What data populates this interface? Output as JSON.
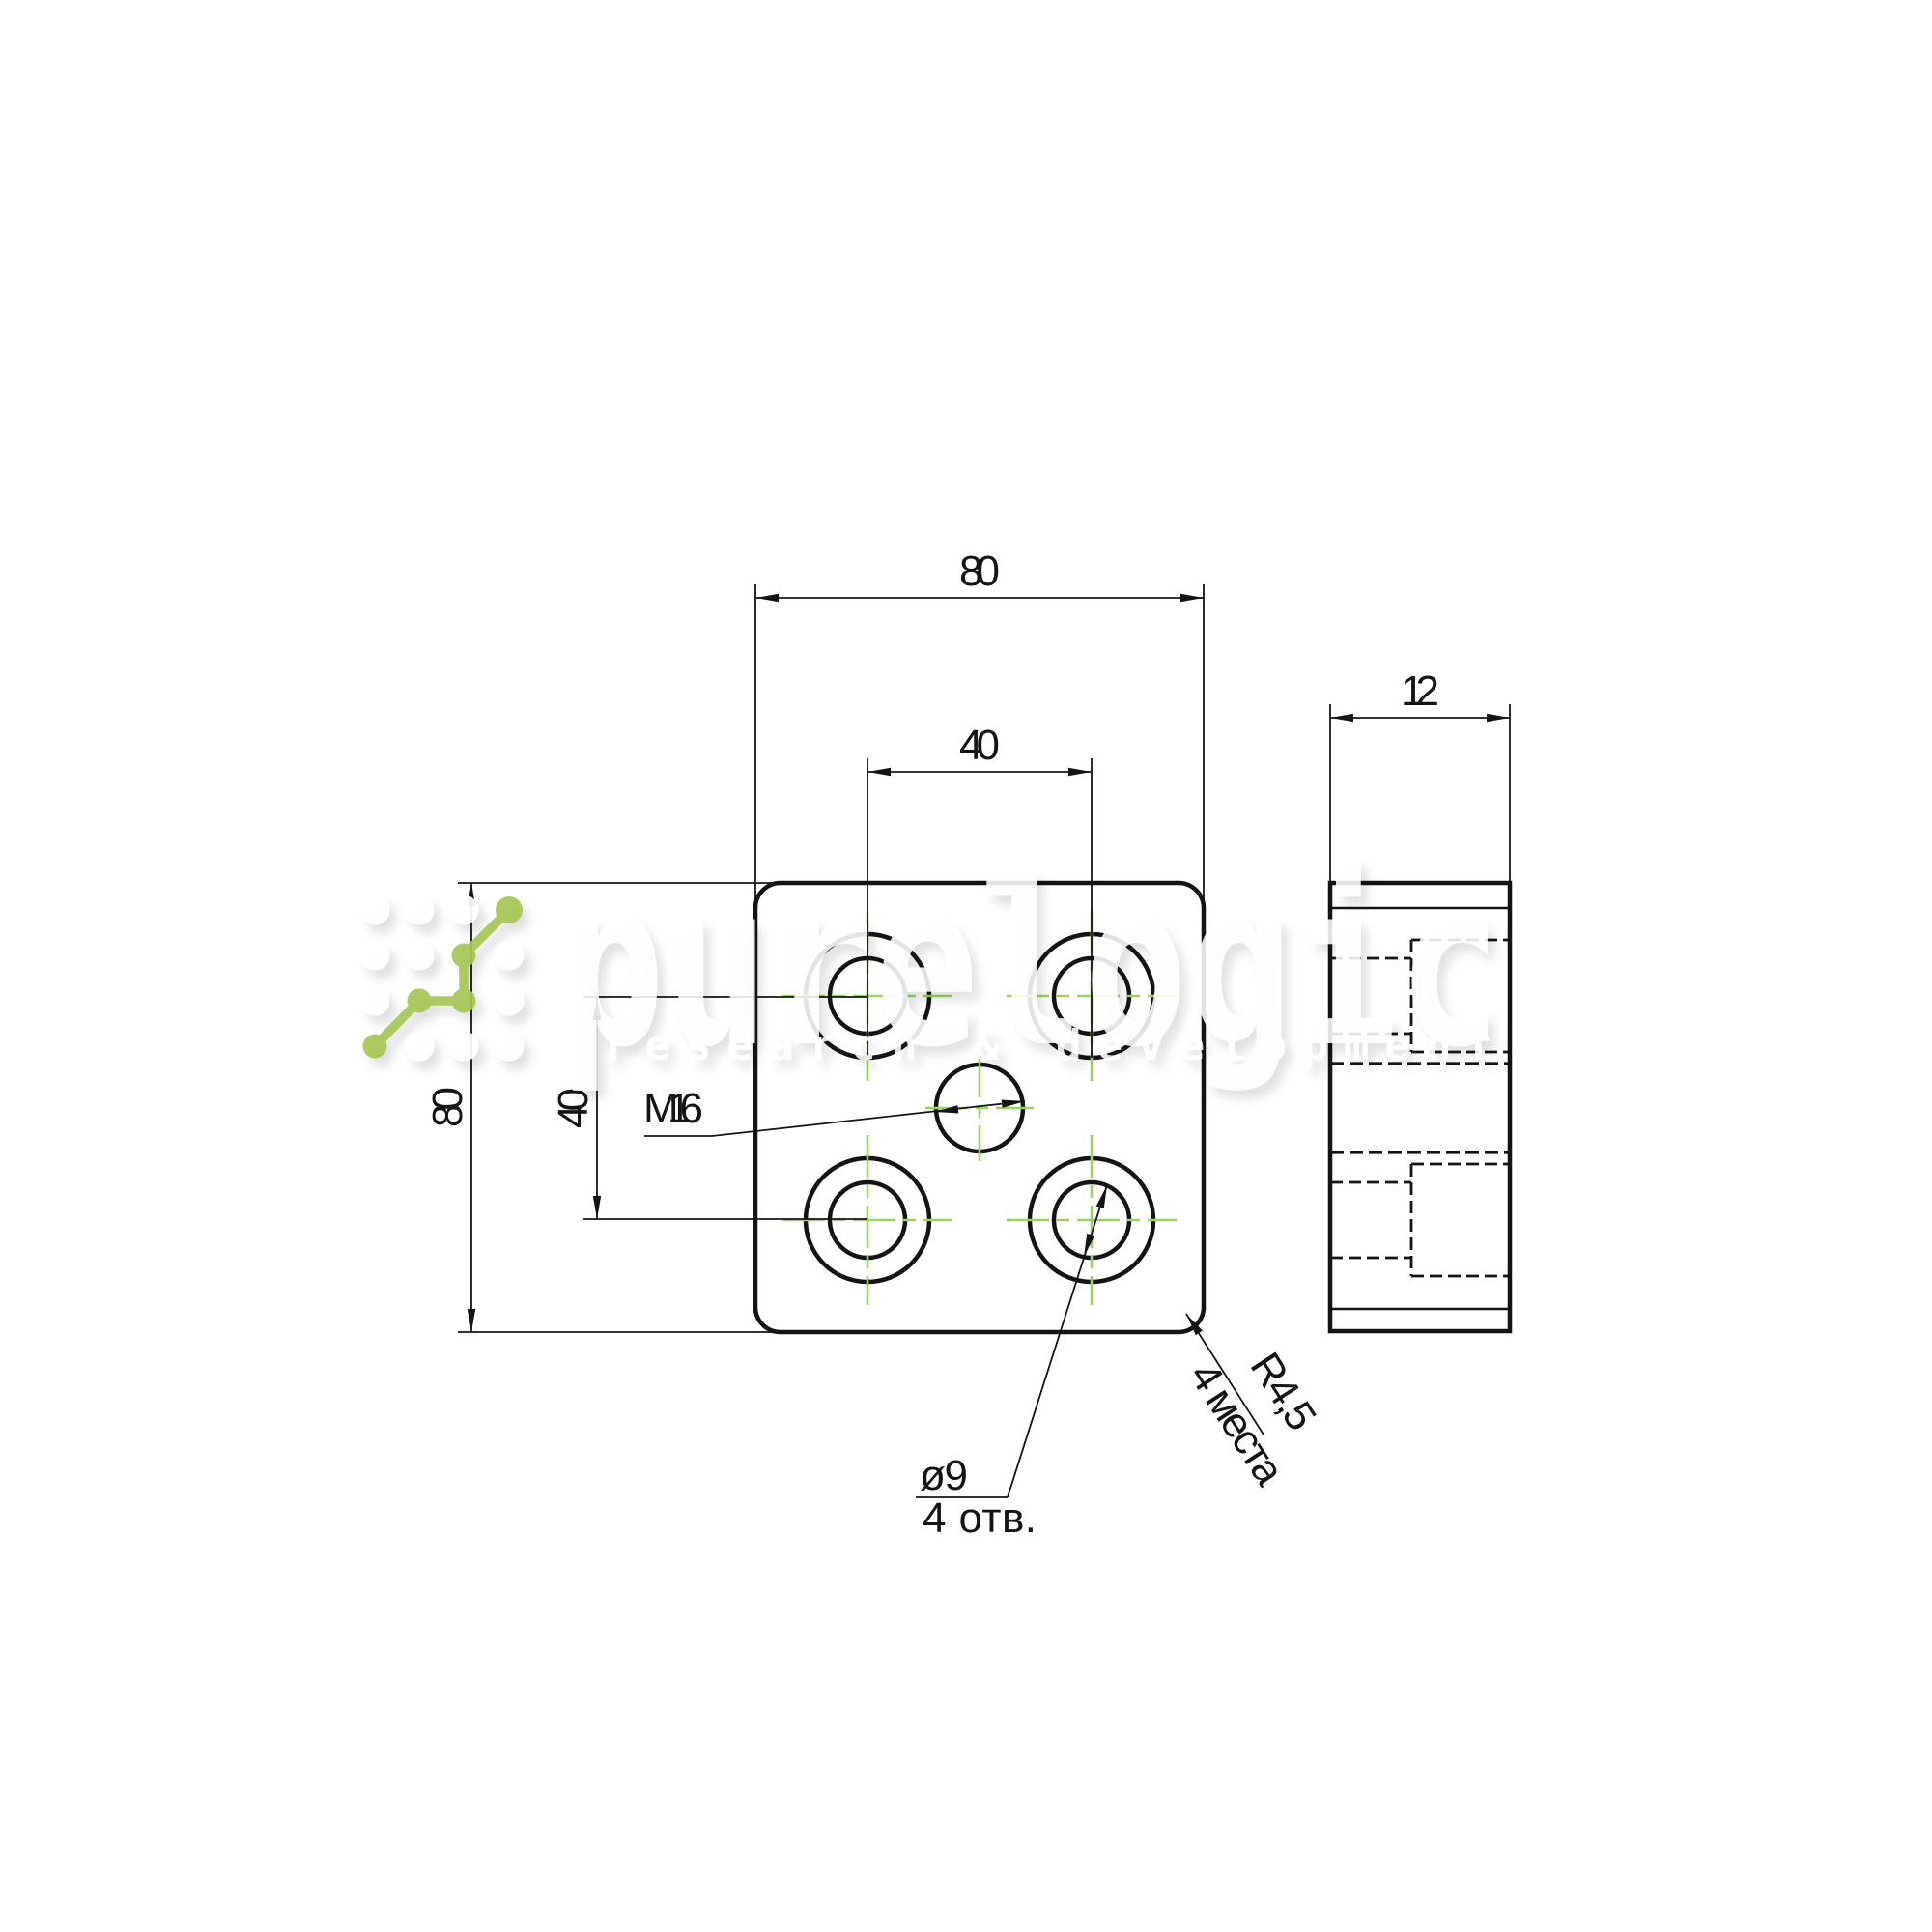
{
  "drawing": {
    "front_view": {
      "width_label": "80",
      "height_label": "80",
      "hole_spacing_x_label": "40",
      "hole_spacing_y_label": "40",
      "center_hole_label": "M16",
      "hole_diameter_label": "ø9",
      "hole_count_label": "4 отв.",
      "corner_radius_label": "R4,5",
      "corner_radius_count_label": "4 места"
    },
    "side_view": {
      "thickness_label": "12"
    }
  },
  "watermark": {
    "brand": "purelogic",
    "tagline": "research & development"
  },
  "colors": {
    "line": "#141414",
    "centerline_green": "#97d55e",
    "logo_green": "#a6c654"
  }
}
